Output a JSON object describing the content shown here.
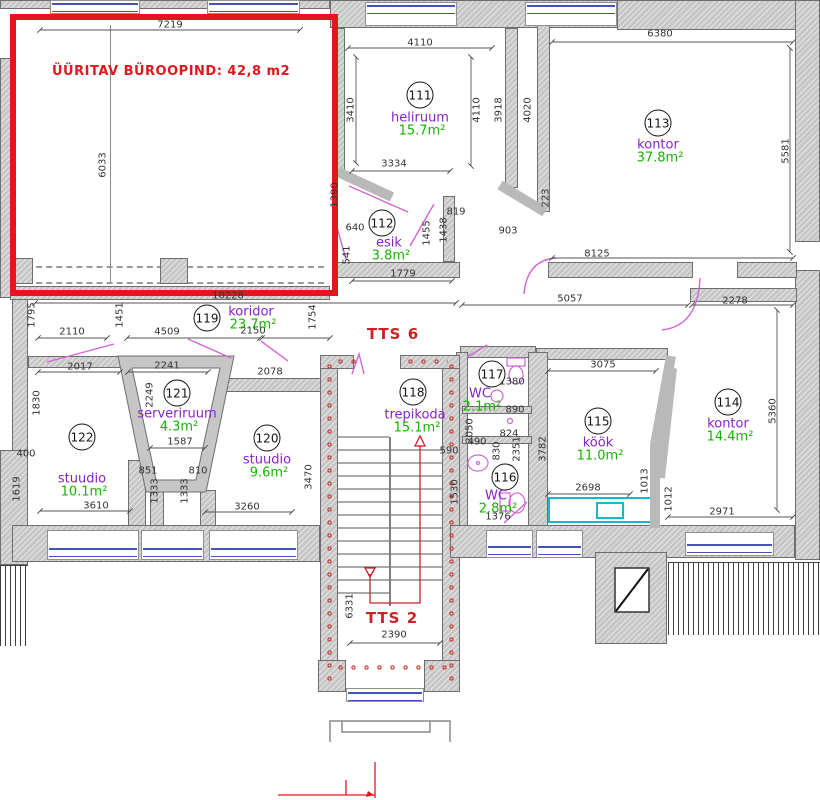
{
  "plan": {
    "highlight_label": "ÜÜRITAV BÜROOPIND: 42,8 m2",
    "stair_labels": [
      {
        "text": "TTS 6",
        "x": 393,
        "y": 334
      },
      {
        "text": "TTS 2",
        "x": 392,
        "y": 618
      }
    ],
    "rooms": [
      {
        "num": "111",
        "name": "heliruum",
        "area": "15.7m²",
        "nx": 420,
        "ny": 95,
        "lx": 420,
        "ly": 118
      },
      {
        "num": "112",
        "name": "esik",
        "area": "3.8m²",
        "nx": 382,
        "ny": 223,
        "lx": 389,
        "ly": 243
      },
      {
        "num": "113",
        "name": "kontor",
        "area": "37.8m²",
        "nx": 658,
        "ny": 123,
        "lx": 658,
        "ly": 145
      },
      {
        "num": "114",
        "name": "kontor",
        "area": "14.4m²",
        "nx": 728,
        "ny": 402,
        "lx": 728,
        "ly": 424
      },
      {
        "num": "115",
        "name": "köök",
        "area": "11.0m²",
        "nx": 598,
        "ny": 421,
        "lx": 598,
        "ly": 443
      },
      {
        "num": "116",
        "name": "WC",
        "area": "2.8m²",
        "nx": 505,
        "ny": 477,
        "lx": 496,
        "ly": 496
      },
      {
        "num": "117",
        "name": "WC",
        "area": "2.1m²",
        "nx": 492,
        "ny": 374,
        "lx": 480,
        "ly": 394
      },
      {
        "num": "118",
        "name": "trepikoda",
        "area": "15.1m²",
        "nx": 413,
        "ny": 392,
        "lx": 415,
        "ly": 415
      },
      {
        "num": "119",
        "name": "koridor",
        "area": "23.7m²",
        "nx": 207,
        "ny": 318,
        "lx": 251,
        "ly": 312
      },
      {
        "num": "120",
        "name": "stuudio",
        "area": "9.6m²",
        "nx": 267,
        "ny": 438,
        "lx": 267,
        "ly": 460
      },
      {
        "num": "121",
        "name": "serveriruum",
        "area": "4.3m²",
        "nx": 177,
        "ny": 393,
        "lx": 177,
        "ly": 414
      },
      {
        "num": "122",
        "name": "stuudio",
        "area": "10.1m²",
        "nx": 82,
        "ny": 437,
        "lx": 82,
        "ly": 479
      }
    ],
    "dims": [
      {
        "t": "7219",
        "x": 170,
        "y": 25
      },
      {
        "t": "6033",
        "x": 103,
        "y": 165,
        "v": 1
      },
      {
        "t": "10228",
        "x": 228,
        "y": 296
      },
      {
        "t": "4110",
        "x": 420,
        "y": 43
      },
      {
        "t": "3410",
        "x": 351,
        "y": 110,
        "v": 1
      },
      {
        "t": "3334",
        "x": 394,
        "y": 164
      },
      {
        "t": "4110",
        "x": 477,
        "y": 110,
        "v": 1
      },
      {
        "t": "3918",
        "x": 499,
        "y": 110,
        "v": 1
      },
      {
        "t": "4020",
        "x": 528,
        "y": 110,
        "v": 1
      },
      {
        "t": "1390",
        "x": 335,
        "y": 195,
        "v": 1
      },
      {
        "t": "640",
        "x": 355,
        "y": 228
      },
      {
        "t": "541",
        "x": 347,
        "y": 255,
        "v": 1
      },
      {
        "t": "1779",
        "x": 403,
        "y": 274
      },
      {
        "t": "1455",
        "x": 427,
        "y": 233,
        "v": 1
      },
      {
        "t": "1438",
        "x": 444,
        "y": 230,
        "v": 1
      },
      {
        "t": "819",
        "x": 456,
        "y": 212
      },
      {
        "t": "903",
        "x": 508,
        "y": 231
      },
      {
        "t": "6380",
        "x": 660,
        "y": 34
      },
      {
        "t": "5581",
        "x": 786,
        "y": 151,
        "v": 1
      },
      {
        "t": "223",
        "x": 546,
        "y": 198,
        "v": 1
      },
      {
        "t": "8125",
        "x": 597,
        "y": 254
      },
      {
        "t": "5057",
        "x": 570,
        "y": 299
      },
      {
        "t": "2278",
        "x": 735,
        "y": 301
      },
      {
        "t": "3075",
        "x": 603,
        "y": 365
      },
      {
        "t": "1795",
        "x": 32,
        "y": 315,
        "v": 1
      },
      {
        "t": "2110",
        "x": 72,
        "y": 332
      },
      {
        "t": "1451",
        "x": 120,
        "y": 315,
        "v": 1
      },
      {
        "t": "4509",
        "x": 167,
        "y": 332
      },
      {
        "t": "2150",
        "x": 253,
        "y": 331
      },
      {
        "t": "1754",
        "x": 313,
        "y": 317,
        "v": 1
      },
      {
        "t": "2241",
        "x": 167,
        "y": 366
      },
      {
        "t": "2078",
        "x": 270,
        "y": 372
      },
      {
        "t": "2017",
        "x": 80,
        "y": 367
      },
      {
        "t": "1830",
        "x": 37,
        "y": 403,
        "v": 1
      },
      {
        "t": "400",
        "x": 26,
        "y": 454
      },
      {
        "t": "1619",
        "x": 17,
        "y": 489,
        "v": 1
      },
      {
        "t": "3610",
        "x": 96,
        "y": 506
      },
      {
        "t": "2249",
        "x": 150,
        "y": 395,
        "v": 1
      },
      {
        "t": "1587",
        "x": 180,
        "y": 442
      },
      {
        "t": "851",
        "x": 148,
        "y": 471
      },
      {
        "t": "810",
        "x": 198,
        "y": 471
      },
      {
        "t": "1333",
        "x": 155,
        "y": 491,
        "v": 1
      },
      {
        "t": "1333",
        "x": 185,
        "y": 491,
        "v": 1
      },
      {
        "t": "3260",
        "x": 247,
        "y": 507
      },
      {
        "t": "3470",
        "x": 309,
        "y": 477,
        "v": 1
      },
      {
        "t": "6331",
        "x": 350,
        "y": 606,
        "v": 1
      },
      {
        "t": "2390",
        "x": 394,
        "y": 635
      },
      {
        "t": "590",
        "x": 449,
        "y": 451
      },
      {
        "t": "1530",
        "x": 455,
        "y": 492,
        "v": 1
      },
      {
        "t": "2050",
        "x": 470,
        "y": 431,
        "v": 1
      },
      {
        "t": "1380",
        "x": 512,
        "y": 382
      },
      {
        "t": "890",
        "x": 515,
        "y": 410
      },
      {
        "t": "824",
        "x": 509,
        "y": 434
      },
      {
        "t": "490",
        "x": 477,
        "y": 442
      },
      {
        "t": "830",
        "x": 497,
        "y": 451,
        "v": 1
      },
      {
        "t": "2351",
        "x": 517,
        "y": 449,
        "v": 1
      },
      {
        "t": "1376",
        "x": 498,
        "y": 517
      },
      {
        "t": "3782",
        "x": 543,
        "y": 449,
        "v": 1
      },
      {
        "t": "2698",
        "x": 588,
        "y": 488
      },
      {
        "t": "1013",
        "x": 645,
        "y": 481,
        "v": 1
      },
      {
        "t": "1012",
        "x": 669,
        "y": 499,
        "v": 1
      },
      {
        "t": "5360",
        "x": 773,
        "y": 411,
        "v": 1
      },
      {
        "t": "2971",
        "x": 722,
        "y": 512
      }
    ],
    "colors": {
      "highlight": "#e0181d",
      "room_name": "#8822cc",
      "room_area": "#15b400",
      "stair_text": "#cc2125",
      "dims": "#333333",
      "door": "#d565d5",
      "window": "#4553b4",
      "counter": "#18b8cc"
    }
  }
}
